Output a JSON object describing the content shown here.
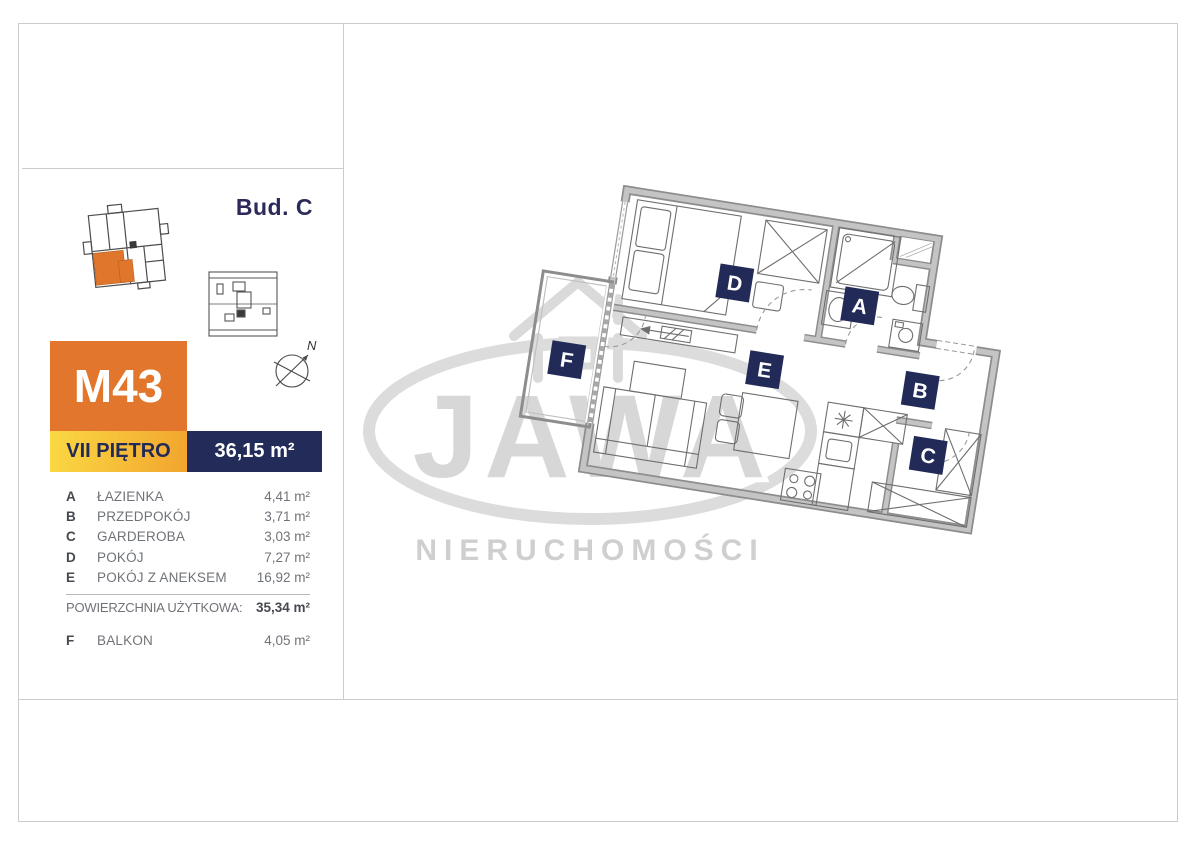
{
  "header": {
    "building": "Bud. C"
  },
  "unit": {
    "id": "M43",
    "floor": "VII PIĘTRO",
    "area": "36,15 m²"
  },
  "rooms": [
    {
      "letter": "A",
      "name": "ŁAZIENKA",
      "area": "4,41 m²"
    },
    {
      "letter": "B",
      "name": "PRZEDPOKÓJ",
      "area": "3,71 m²"
    },
    {
      "letter": "C",
      "name": "GARDEROBA",
      "area": "3,03 m²"
    },
    {
      "letter": "D",
      "name": "POKÓJ",
      "area": "7,27 m²"
    },
    {
      "letter": "E",
      "name": "POKÓJ Z ANEKSEM",
      "area": "16,92 m²"
    }
  ],
  "usable_area": {
    "label": "POWIERZCHNIA UŻYTKOWA:",
    "value": "35,34 m²"
  },
  "balcony": {
    "letter": "F",
    "name": "BALKON",
    "area": "4,05 m²"
  },
  "compass": {
    "north": "N"
  },
  "floorplan": {
    "room_labels": {
      "a": "A",
      "b": "B",
      "c": "C",
      "d": "D",
      "e": "E",
      "f": "F"
    }
  },
  "watermark": {
    "brand": "JAWA",
    "subtitle": "NIERUCHOMOŚCI"
  },
  "colors": {
    "brand_orange": "#e1762c",
    "brand_navy": "#232b58",
    "accent_yellow_start": "#fad843",
    "accent_yellow_end": "#f2a52e",
    "watermark_gray": "#d7d7d7",
    "wall_gray": "#8d8d8d"
  }
}
